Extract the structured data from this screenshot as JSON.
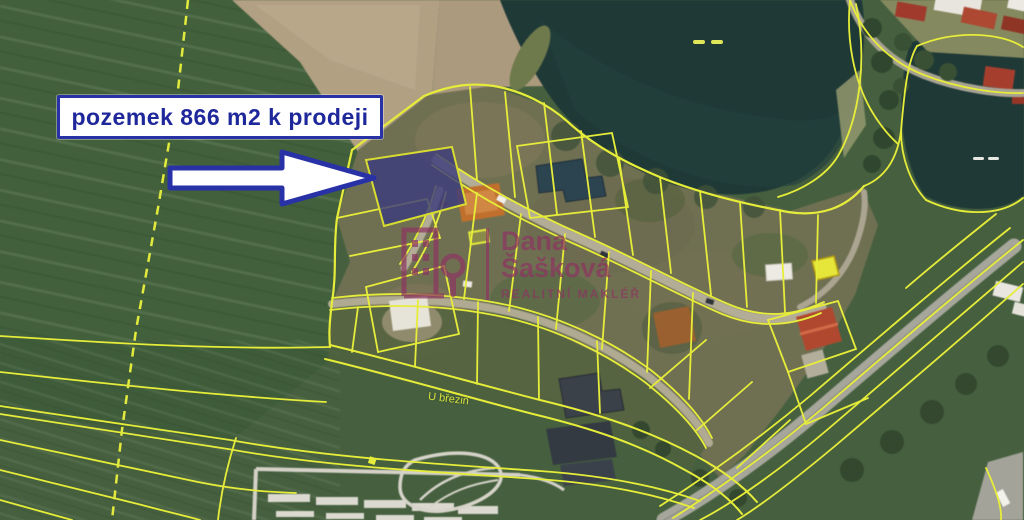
{
  "callout": {
    "text": "pozemek 866 m2 k prodeji"
  },
  "watermark": {
    "name_line1": "Dana",
    "name_line2": "Šašková",
    "subtitle": "REALITNÍ MAKLÉŘ"
  },
  "labels": {
    "street": "U březin"
  },
  "colors": {
    "callout_blue": "#2832a6",
    "callout_text": "#1f289a",
    "parcel_line_yellow": "#e6ec3a",
    "highlight_parcel": "#3c3c7c",
    "highlight_parcel_opacity": "0.82",
    "watermark_mauve": "#8c3660",
    "water": "#1f3937",
    "arrow_fill": "#ffffff"
  }
}
